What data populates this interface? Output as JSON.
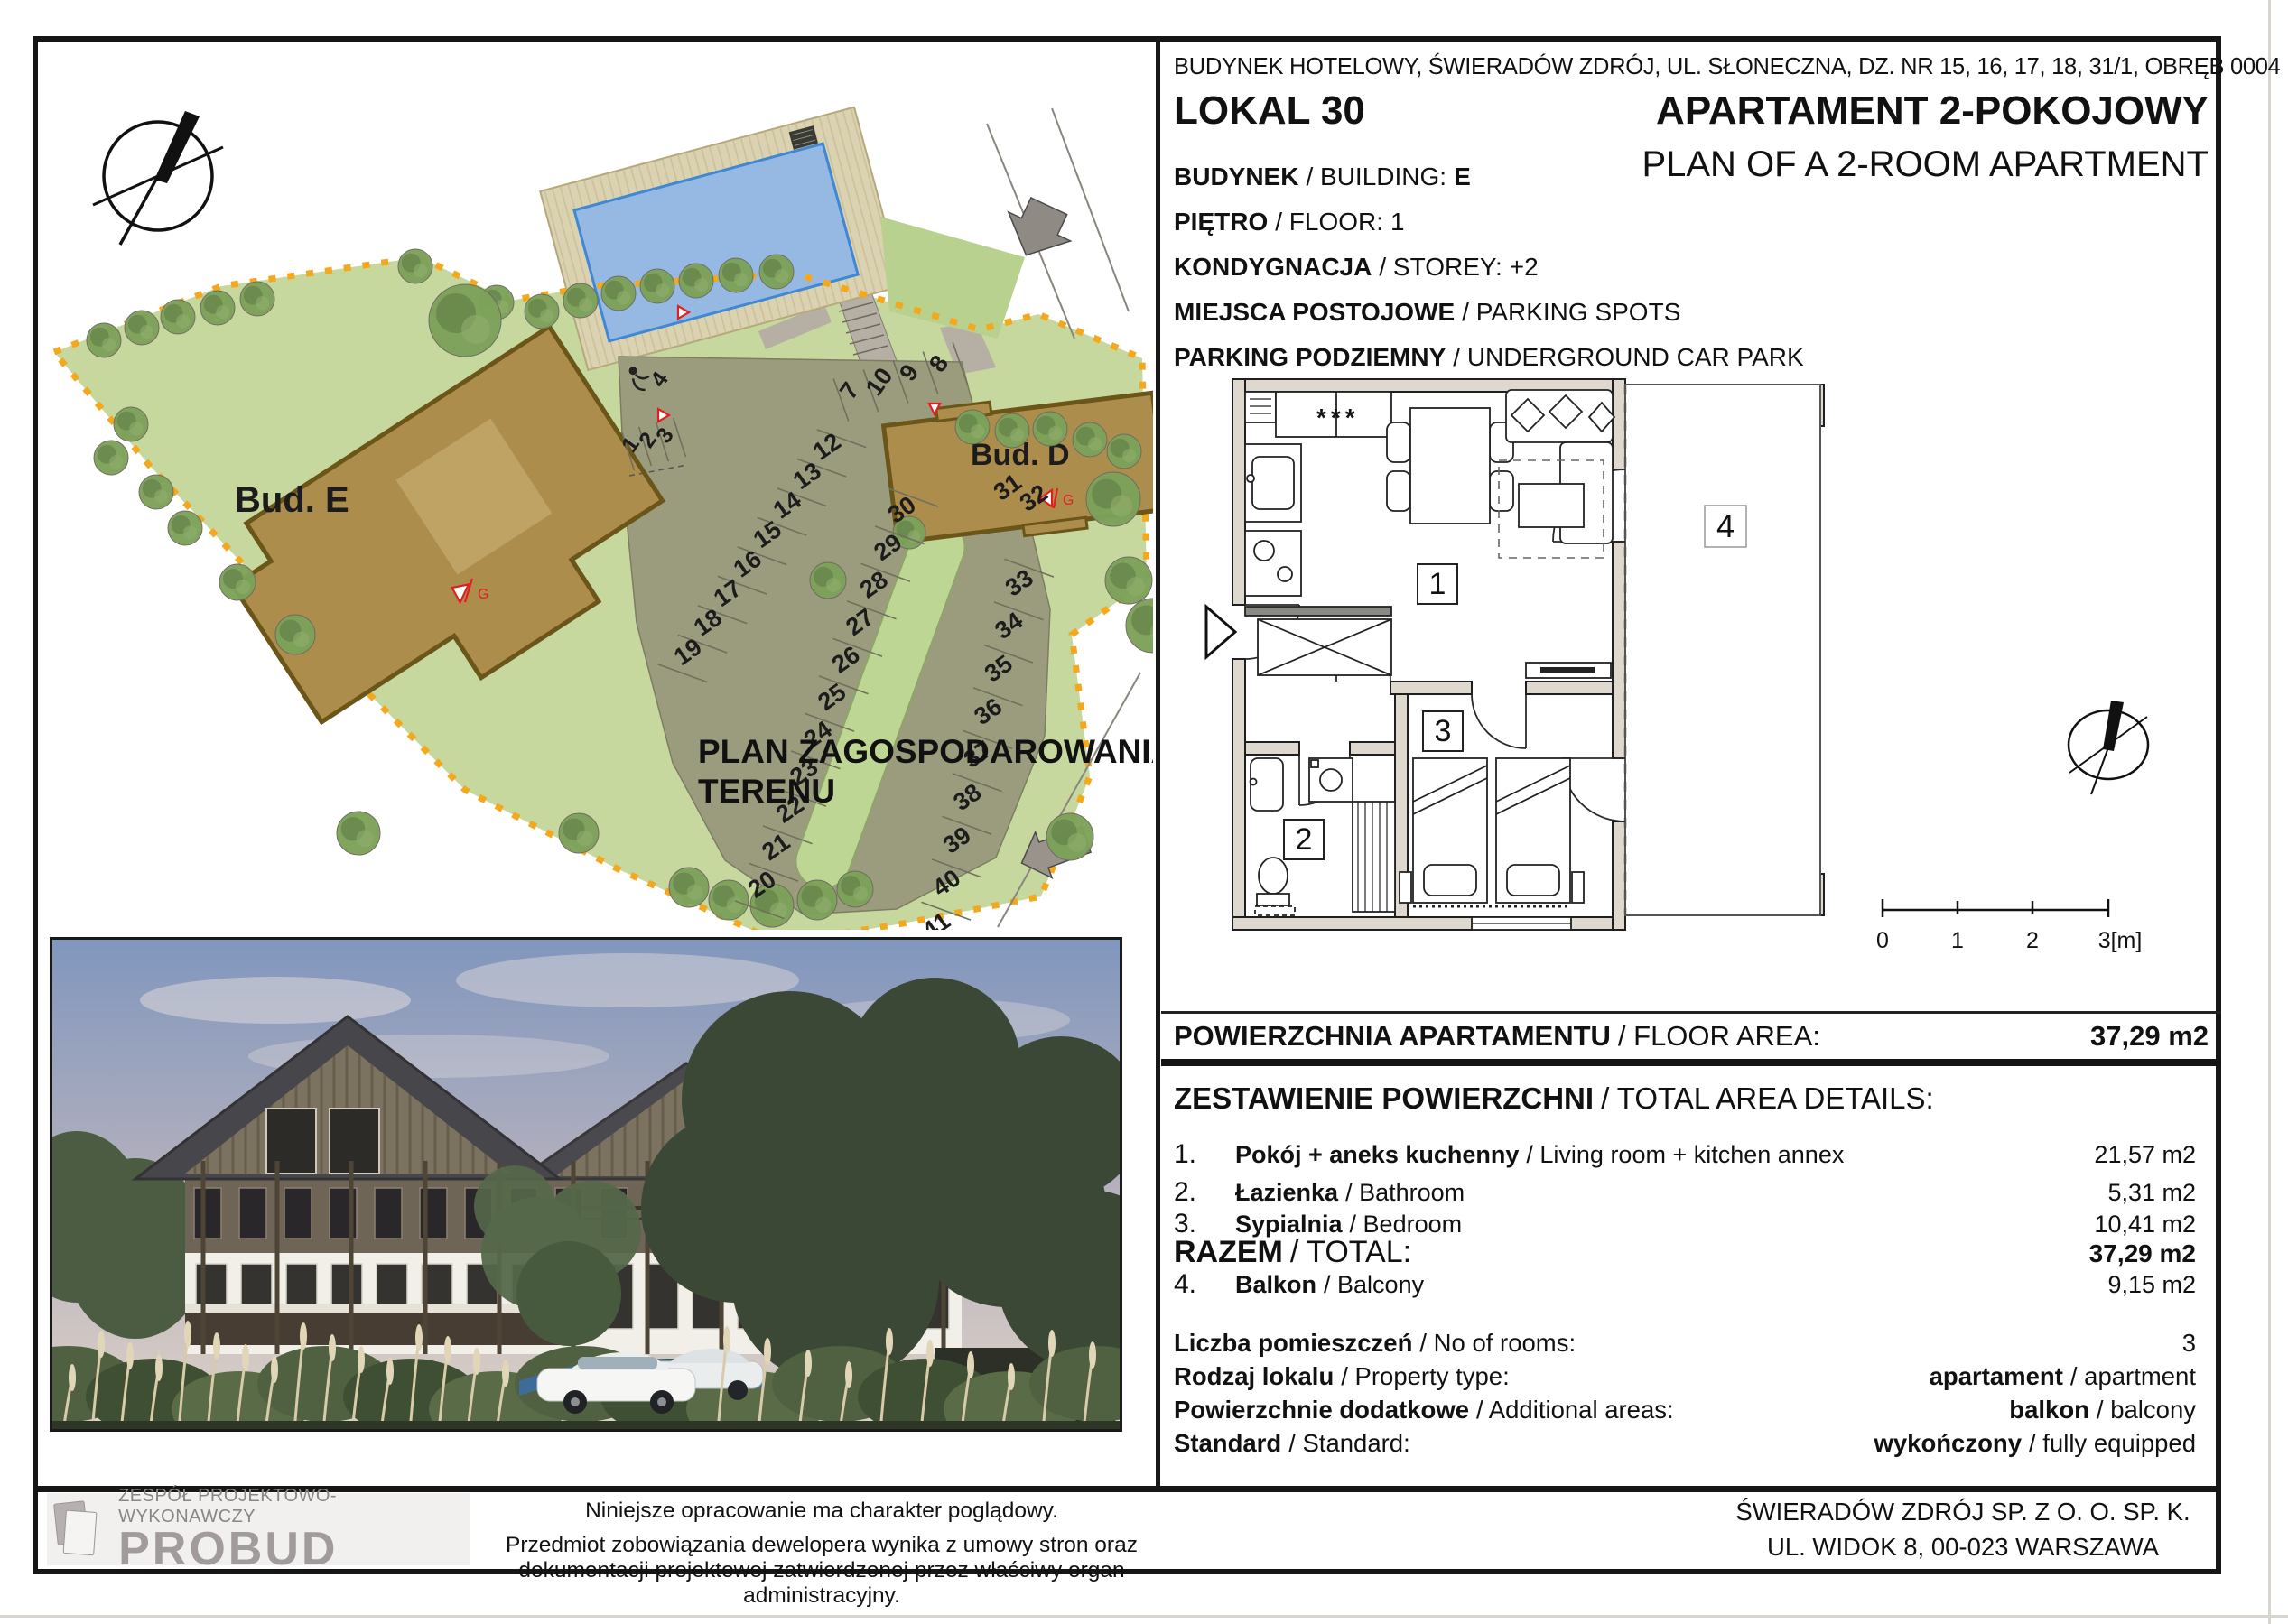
{
  "colors": {
    "boundary_orange": "#F4A81D",
    "grass_green": "#C6D89E",
    "building_brown": "#AD8D4C",
    "pool_blue": "#95B9E2",
    "parking_olive": "#9B9C7E",
    "wall_beige": "#DED8CE",
    "roof_gray": "#4A4A4E"
  },
  "header": {
    "address": "BUDYNEK HOTELOWY, ŚWIERADÓW ZDRÓJ, UL. SŁONECZNA, DZ. NR 15, 16, 17, 18, 31/1, OBRĘB 0004",
    "lokal": "LOKAL 30",
    "title_pl": "APARTAMENT 2-POKOJOWY",
    "title_en": "PLAN OF A 2-ROOM APARTMENT",
    "details": [
      {
        "pl": "BUDYNEK",
        "en": "/ BUILDING:",
        "value": "E"
      },
      {
        "pl": "PIĘTRO",
        "en": "/ FLOOR:",
        "value": "1"
      },
      {
        "pl": "KONDYGNACJA",
        "en": "/ STOREY:",
        "value": "+2"
      },
      {
        "pl": "MIEJSCA POSTOJOWE",
        "en": "/ PARKING SPOTS",
        "value": ""
      },
      {
        "pl": "PARKING PODZIEMNY",
        "en": "/ UNDERGROUND CAR PARK",
        "value": ""
      }
    ]
  },
  "floor_area": {
    "pl": "POWIERZCHNIA APARTAMENTU",
    "en": "/ FLOOR AREA:",
    "value": "37,29 m2"
  },
  "area_details": {
    "heading_pl": "ZESTAWIENIE POWIERZCHNI",
    "heading_en": "/ TOTAL AREA DETAILS:",
    "rows": [
      {
        "no": "1.",
        "pl": "Pokój + aneks kuchenny",
        "en": "/ Living room + kitchen annex",
        "area": "21,57 m2"
      },
      {
        "no": "2.",
        "pl": "Łazienka",
        "en": "/ Bathroom",
        "area": "5,31 m2"
      },
      {
        "no": "3.",
        "pl": "Sypialnia",
        "en": "/ Bedroom",
        "area": "10,41 m2"
      }
    ],
    "total": {
      "pl": "RAZEM",
      "en": "/ TOTAL:",
      "area": "37,29 m2"
    },
    "balcony": {
      "no": "4.",
      "pl": "Balkon",
      "en": "/ Balcony",
      "area": "9,15 m2"
    }
  },
  "property": {
    "rows": [
      {
        "pl": "Liczba pomieszczeń",
        "en": "/ No of rooms:",
        "value_pl": "",
        "value_en": "3"
      },
      {
        "pl": "Rodzaj lokalu",
        "en": "/ Property type:",
        "value_pl": "apartament",
        "value_en": "/ apartment"
      },
      {
        "pl": "Powierzchnie dodatkowe",
        "en": "/ Additional areas:",
        "value_pl": "balkon",
        "value_en": "/ balcony"
      },
      {
        "pl": "Standard",
        "en": "/ Standard:",
        "value_pl": "wykończony",
        "value_en": "/ fully equipped"
      }
    ]
  },
  "site_plan": {
    "title_line1": "PLAN ZAGOSPODAROWANIA",
    "title_line2": "TERENU",
    "building_e": "Bud. E",
    "building_d": "Bud. D",
    "parking": {
      "top_row": [
        "7",
        "10",
        "9",
        "8"
      ],
      "handicap_row": [
        "4"
      ],
      "entrance_row": [
        "1",
        "2",
        "3"
      ],
      "left_column": [
        "12",
        "13",
        "14",
        "15",
        "16",
        "17",
        "18",
        "19"
      ],
      "middle_column": [
        "30",
        "29",
        "28",
        "27",
        "26",
        "25",
        "24",
        "23",
        "22",
        "21",
        "20"
      ],
      "right_row": [
        "31",
        "32"
      ],
      "right_column": [
        "33",
        "34",
        "35",
        "36",
        "37",
        "38",
        "39",
        "40",
        "41"
      ],
      "garage_marker": "G"
    }
  },
  "floor_plan": {
    "rooms": [
      "1",
      "2",
      "3",
      "4"
    ],
    "kitchen_symbol": "***",
    "scale_ticks": [
      "0",
      "1",
      "2",
      "3[m]"
    ]
  },
  "footer": {
    "logo_tagline": "ZESPÓŁ PROJEKTOWO-WYKONAWCZY",
    "logo_name": "PROBUD",
    "disclaimer1": "Niniejsze opracowanie ma charakter  poglądowy.",
    "disclaimer2": "Przedmiot zobowiązania dewelopera wynika z umowy stron oraz dokumentacji projektowej zatwierdzonej przez właściwy organ administracyjny.",
    "company1": "ŚWIERADÓW ZDRÓJ SP. Z O. O. SP. K.",
    "company2": "UL. WIDOK 8, 00-023 WARSZAWA"
  }
}
